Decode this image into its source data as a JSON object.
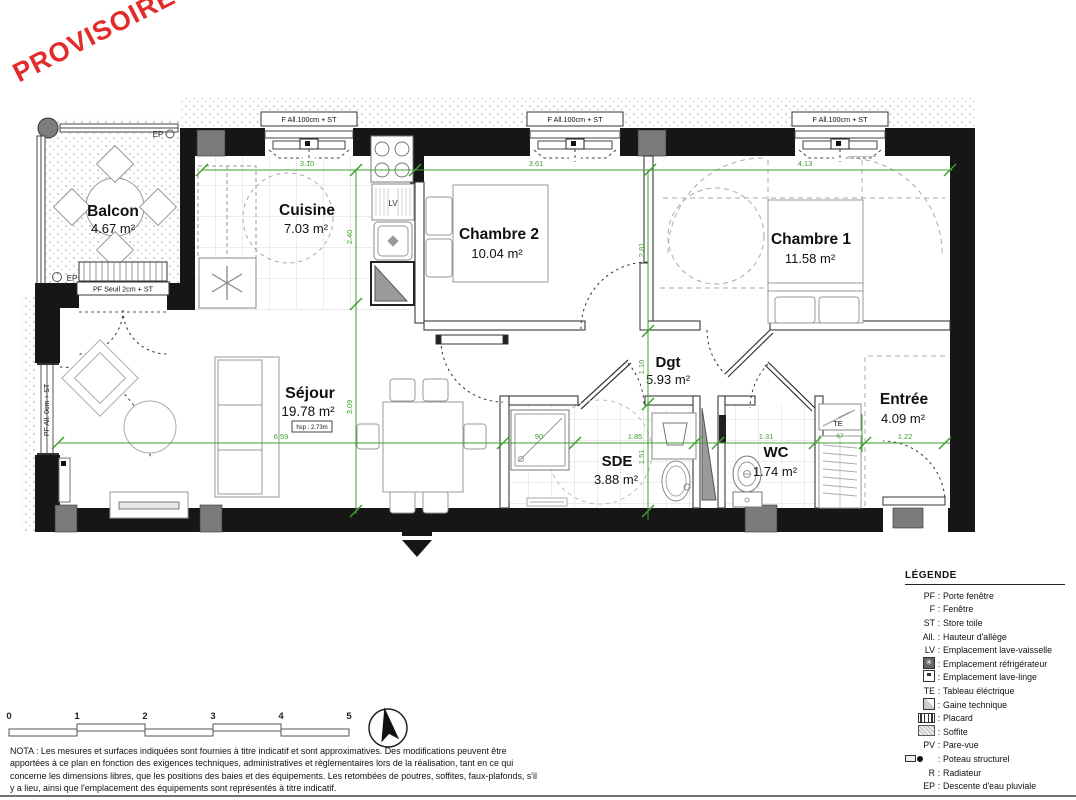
{
  "watermark": "PROVISOIRE",
  "plan": {
    "rooms": [
      {
        "name": "Balcon",
        "area": "4.67 m²"
      },
      {
        "name": "Cuisine",
        "area": "7.03 m²"
      },
      {
        "name": "Chambre 2",
        "area": "10.04 m²"
      },
      {
        "name": "Chambre 1",
        "area": "11.58 m²"
      },
      {
        "name": "Séjour",
        "area": "19.78 m²",
        "hsp": "hsp : 2.73m"
      },
      {
        "name": "Dgt",
        "area": "5.93 m²"
      },
      {
        "name": "SDE",
        "area": "3.88 m²"
      },
      {
        "name": "WC",
        "area": "1.74 m²"
      },
      {
        "name": "Entrée",
        "area": "4.09 m²"
      }
    ],
    "openings": {
      "window_top": "F All.100cm + ST",
      "balcony_door": "PF Seuil 2cm + ST",
      "sejour_window": "PF All. 0cm + ST"
    },
    "tags": {
      "ep": "EP",
      "te": "TE",
      "lv": "LV"
    },
    "dims": [
      "3.10",
      "3.61",
      "4.13",
      "2.40",
      "3.09",
      "2.81",
      "1.10",
      "1.51",
      "6.59",
      "90",
      "1.85",
      "1.31",
      "67",
      "1.22"
    ]
  },
  "scale_bar": {
    "labels": [
      "0",
      "1",
      "2",
      "3",
      "4",
      "5"
    ]
  },
  "legend": {
    "title": "LÉGENDE",
    "sep": ":",
    "items": [
      {
        "code": "PF",
        "desc": "Porte fenêtre"
      },
      {
        "code": "F",
        "desc": "Fenêtre"
      },
      {
        "code": "ST",
        "desc": "Store toile"
      },
      {
        "code": "All.",
        "desc": "Hauteur d'allège"
      },
      {
        "code": "LV",
        "desc": "Emplacement lave-vaisselle"
      },
      {
        "icon": "refrigerator-icon",
        "desc": "Emplacement réfrigérateur"
      },
      {
        "icon": "washing-machine-icon",
        "desc": "Emplacement lave-linge"
      },
      {
        "code": "TE",
        "desc": "Tableau éléctrique"
      },
      {
        "icon": "technical-duct-icon",
        "desc": "Gaine technique"
      },
      {
        "icon": "closet-icon",
        "desc": "Placard"
      },
      {
        "icon": "soffit-icon",
        "desc": "Soffite"
      },
      {
        "code": "PV",
        "desc": "Pare-vue"
      },
      {
        "icon": "structural-column-icon",
        "desc": "Poteau structurel"
      },
      {
        "code": "R",
        "desc": "Radiateur"
      },
      {
        "code": "EP",
        "desc": "Descente d'eau pluviale"
      }
    ]
  },
  "nota": "NOTA : Les mesures et surfaces indiquées sont fournies à titre indicatif et sont approximatives. Des modifications peuvent être apportées à ce plan en fonction des exigences techniques, administratives et règlementaires lors de la réalisation, tant en ce qui concerne les dimensions libres, que les positions des baies et des équipements. Les retombées de poutres, soffites, faux-plafonds, s'il y a lieu, ainsi que l'emplacement des équipements sont représentés à titre indicatif.",
  "colors": {
    "dim_green": "#3f9f2f",
    "watermark_red": "#e32b2b",
    "wall_black": "#161616"
  }
}
